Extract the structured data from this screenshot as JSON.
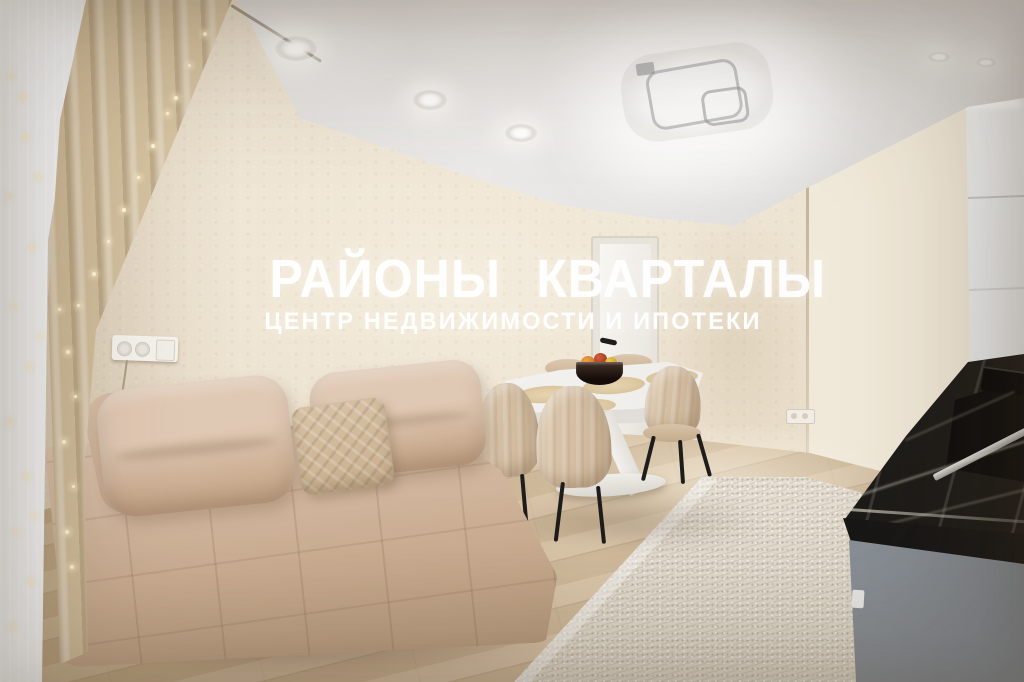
{
  "watermark": {
    "line1": "РАЙОНЫ КВАРТАЛЫ",
    "line2": "ЦЕНТР НЕДВИЖИМОСТИ И ИПОТЕКИ",
    "color": "#ffffff"
  },
  "scene": {
    "type": "real-estate interior photograph",
    "room": "open-plan living room with dining area and kitchen corner",
    "objects": [
      "beige tufted fabric sofa with two back cushions and knitted pillow",
      "white dining table with sculptural X pedestal and oval base plate",
      "beige velvet dining chairs with black metal legs",
      "dark bowl with fruit on the table",
      "oval beige placemats on the table",
      "white interior door with black handle",
      "beige textured stucco walls",
      "white ceiling with recessed round spotlights",
      "square LED ceiling light fixture",
      "white sheer curtain and beige drape with string fairy lights",
      "light oak laminate floor",
      "cream woven rug",
      "black marble worktop with induction hob and sink cutout",
      "grey kitchen base cabinet",
      "tall white kitchen cabinet column",
      "white wall socket strip with switch and hanging cord",
      "small wall socket near corner",
      "white baseboards"
    ],
    "colors": {
      "wall": "#eadfcc",
      "wall_right": "#f0e8d8",
      "ceiling": "#e0dedb",
      "sofa": "#cfb59e",
      "pillow": "#d2bda1",
      "curtain_sheer": "#f3f5f6",
      "curtain_drape": "#ddcbaa",
      "floor": "#ccb493",
      "rug": "#e8e2d7",
      "table": "#f7f6f4",
      "chair": "#d3bea4",
      "marble": "#23211e",
      "cabinet_grey": "#99a0a6",
      "cabinet_white": "#f2f4f4",
      "door": "#f5f3f0",
      "chair_legs": "#1e1d1b",
      "watermark": "#ffffff",
      "fairy_light": "#fff6dd"
    }
  }
}
